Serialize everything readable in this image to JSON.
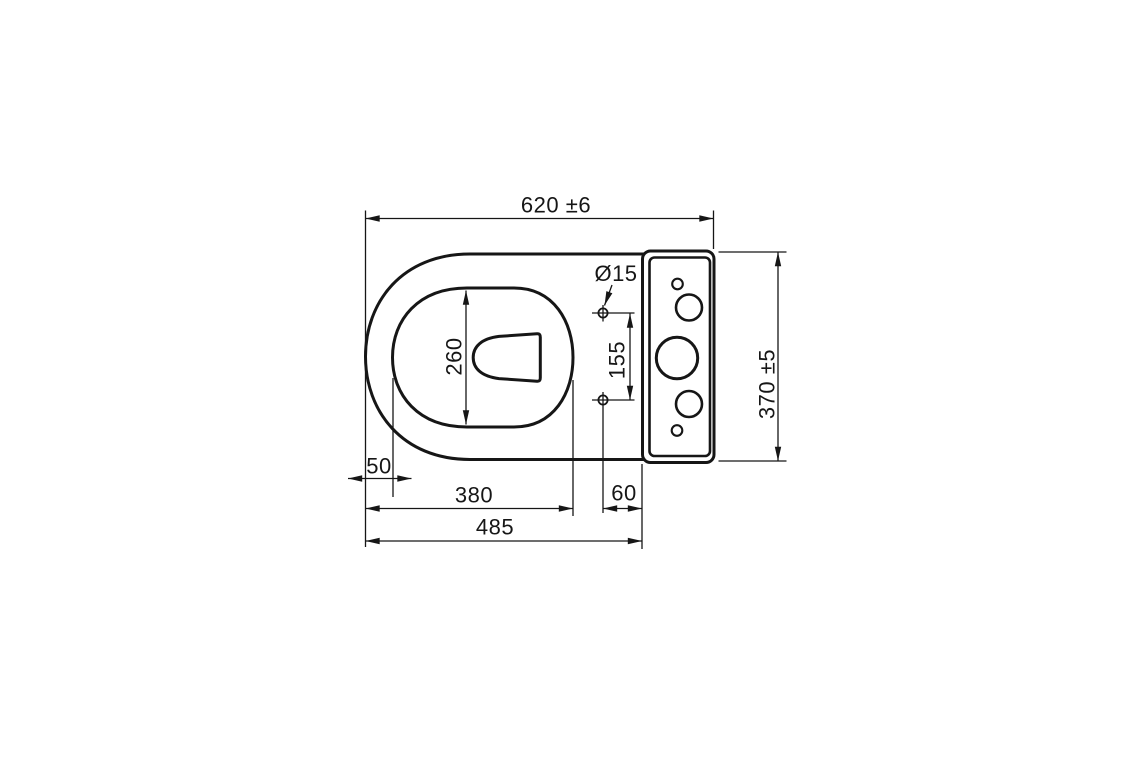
{
  "page": {
    "background": "#ffffff",
    "line_color": "#161616"
  },
  "drawing": {
    "subject": "toilet-pan-with-cistern-plan-view",
    "labels": {
      "overall_length": "620 ±6",
      "overall_width": "370 ±5",
      "bowl_opening_length": "260",
      "seat_hole_spacing": "155",
      "seat_hole_diameter": "Ø15",
      "rim_front_offset": "50",
      "rim_length": "380",
      "seat_hole_to_cistern": "60",
      "bowl_length": "485"
    }
  }
}
